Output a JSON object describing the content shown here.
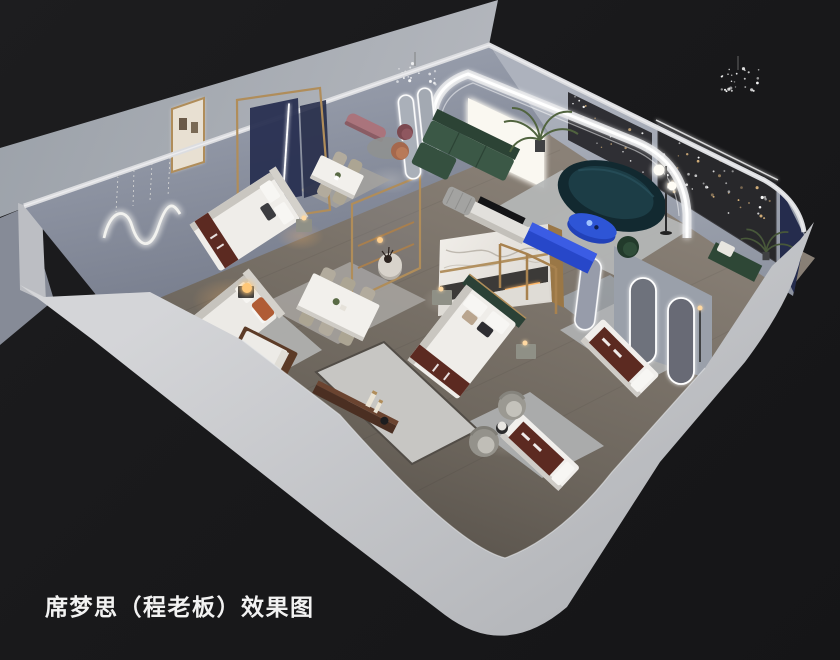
{
  "caption": {
    "text": "席梦思（程老板）效果图"
  },
  "palette": {
    "bg": "#19191b",
    "ground": "#a9adb4",
    "band": "#c9cbce",
    "wallTop": "#dcdde0",
    "wallLeft": "#8d93a1",
    "wallRight": "#a3a9b4",
    "charcoal": "#28282b",
    "navy": "#272e4f",
    "marble": "#ece9e3",
    "gold": "#b08d5a",
    "green": "#3b5846",
    "teal": "#16323c",
    "blue": "#2e55d6",
    "maroon": "#5c2a21",
    "beige": "#b2ab9d",
    "rug": "#b5b7b7",
    "warm": "#ffb768",
    "pink": "#aa747c",
    "rust": "#b05c35",
    "white": "#f4f3f0"
  },
  "objects": [
    "ground-platform",
    "showroom-floor",
    "outer-wall-band",
    "back-left-wall",
    "back-right-wall",
    "squiggle-wall-light",
    "gallery-doorway",
    "crystal-chandelier-1",
    "crystal-chandelier-2",
    "glass-partition-navy",
    "glass-partition-small",
    "marble-feature-wall",
    "led-arch",
    "pill-mirrors",
    "arched-mirror-wall",
    "standing-mirror",
    "lightbox-window",
    "fairy-light-panel-main",
    "fairy-light-panel-upper",
    "navy-corner-wall",
    "bed-display-a",
    "bed-display-b",
    "bed-display-c",
    "wood-daybed",
    "four-poster-frame",
    "mattress-display-1",
    "mattress-display-2",
    "dining-set-small",
    "dining-set-large",
    "green-sectional-sofa",
    "curved-teal-sofa",
    "blue-oval-table",
    "blue-media-console",
    "white-media-console",
    "tv-screen",
    "striped-ottoman",
    "green-accent-chair",
    "armchair-pair",
    "side-table",
    "walkway-bench",
    "round-pedestal-table",
    "pink-bench",
    "round-rug-set",
    "palm-plant",
    "corner-plant",
    "sphere-floor-lamp",
    "arch-floor-lamp",
    "green-pillow-bench",
    "caption"
  ]
}
